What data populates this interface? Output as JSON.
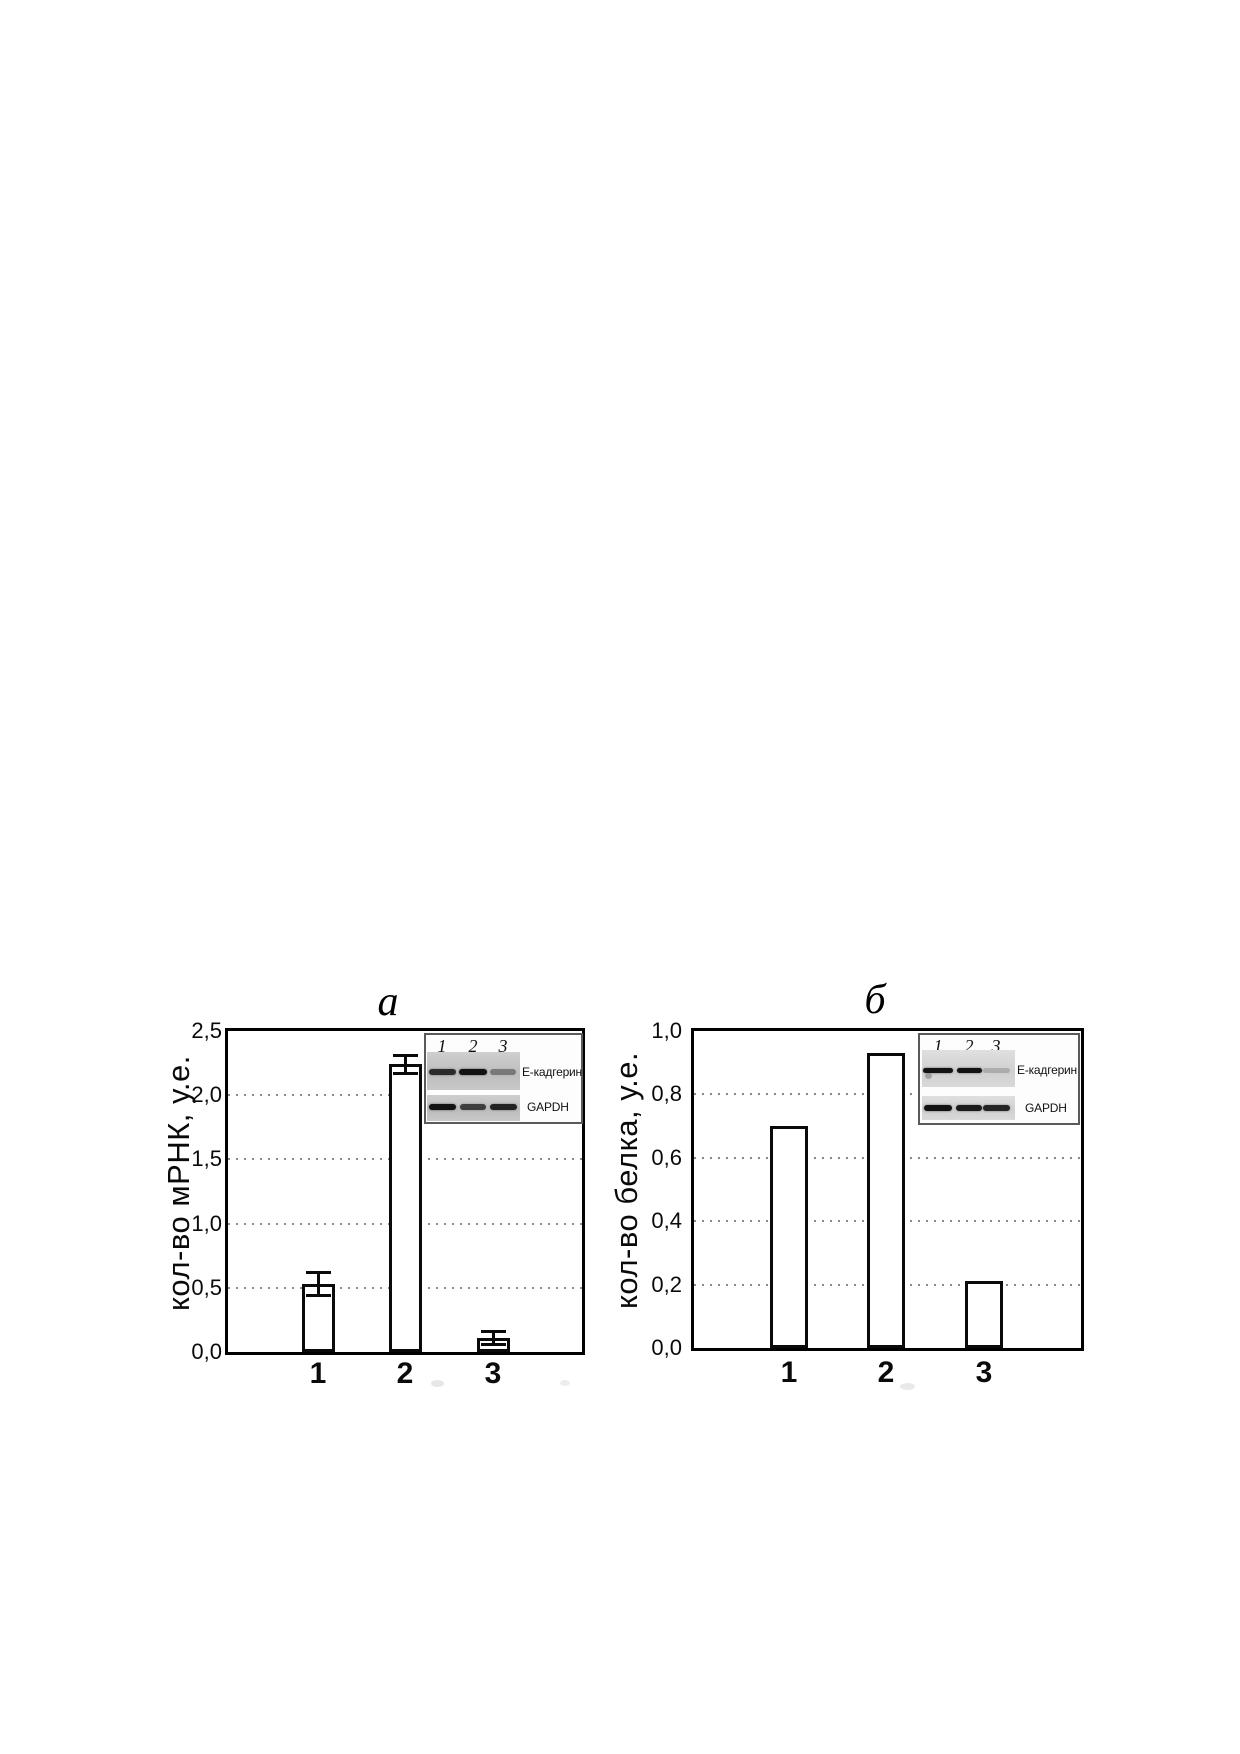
{
  "figure": {
    "kind": "two-panel bar figure with gel inset images",
    "panel_labels": [
      "a",
      "б"
    ]
  },
  "colors": {
    "background": "#ffffff",
    "axis": "#000000",
    "bar_fill": "#ffffff",
    "grid_dots": "#8a8a8a",
    "gel_strip_left": "#c6c6c6",
    "gel_strip_right": "#d8d8d8",
    "gel_band": "#121212",
    "inset_border": "#5a5a5a"
  },
  "chart_data": [
    {
      "type": "bar",
      "panel": "left",
      "title": "a",
      "ylabel": "кол-во мРНК, у.е.",
      "xlabel": "",
      "categories": [
        "1",
        "2",
        "3"
      ],
      "values": [
        0.53,
        2.24,
        0.11
      ],
      "errors": [
        0.1,
        0.08,
        0.06
      ],
      "ylim": [
        0,
        2.5
      ],
      "yticks": [
        {
          "label": "0,0",
          "value": 0.0
        },
        {
          "label": "0,5",
          "value": 0.5
        },
        {
          "label": "1,0",
          "value": 1.0
        },
        {
          "label": "1,5",
          "value": 1.5
        },
        {
          "label": "2,0",
          "value": 2.0
        },
        {
          "label": "2,5",
          "value": 2.5
        }
      ],
      "grid": "horizontal-dotted",
      "legend": "none",
      "decimal_separator": ",",
      "inset": {
        "lane_labels": [
          "1",
          "2",
          "3"
        ],
        "rows": [
          {
            "label": "Е-кадгерин",
            "band_intensities": [
              0.85,
              1.0,
              0.4
            ]
          },
          {
            "label": "GAPDH",
            "band_intensities": [
              1.0,
              0.75,
              0.9
            ]
          }
        ]
      }
    },
    {
      "type": "bar",
      "panel": "right",
      "title": "б",
      "ylabel": "кол-во белка, у.е.",
      "xlabel": "",
      "categories": [
        "1",
        "2",
        "3"
      ],
      "values": [
        0.7,
        0.93,
        0.21
      ],
      "errors": null,
      "ylim": [
        0,
        1.0
      ],
      "yticks": [
        {
          "label": "0,0",
          "value": 0.0
        },
        {
          "label": "0,2",
          "value": 0.2
        },
        {
          "label": "0,4",
          "value": 0.4
        },
        {
          "label": "0,6",
          "value": 0.6
        },
        {
          "label": "0,8",
          "value": 0.8
        },
        {
          "label": "1,0",
          "value": 1.0
        }
      ],
      "grid": "horizontal-dotted",
      "legend": "none",
      "decimal_separator": ",",
      "inset": {
        "lane_labels": [
          "1",
          "2",
          "3"
        ],
        "rows": [
          {
            "label": "Е-кадгерин",
            "band_intensities": [
              1.0,
              1.0,
              0.18
            ]
          },
          {
            "label": "GAPDH",
            "band_intensities": [
              1.0,
              0.95,
              0.9
            ]
          }
        ]
      }
    }
  ]
}
